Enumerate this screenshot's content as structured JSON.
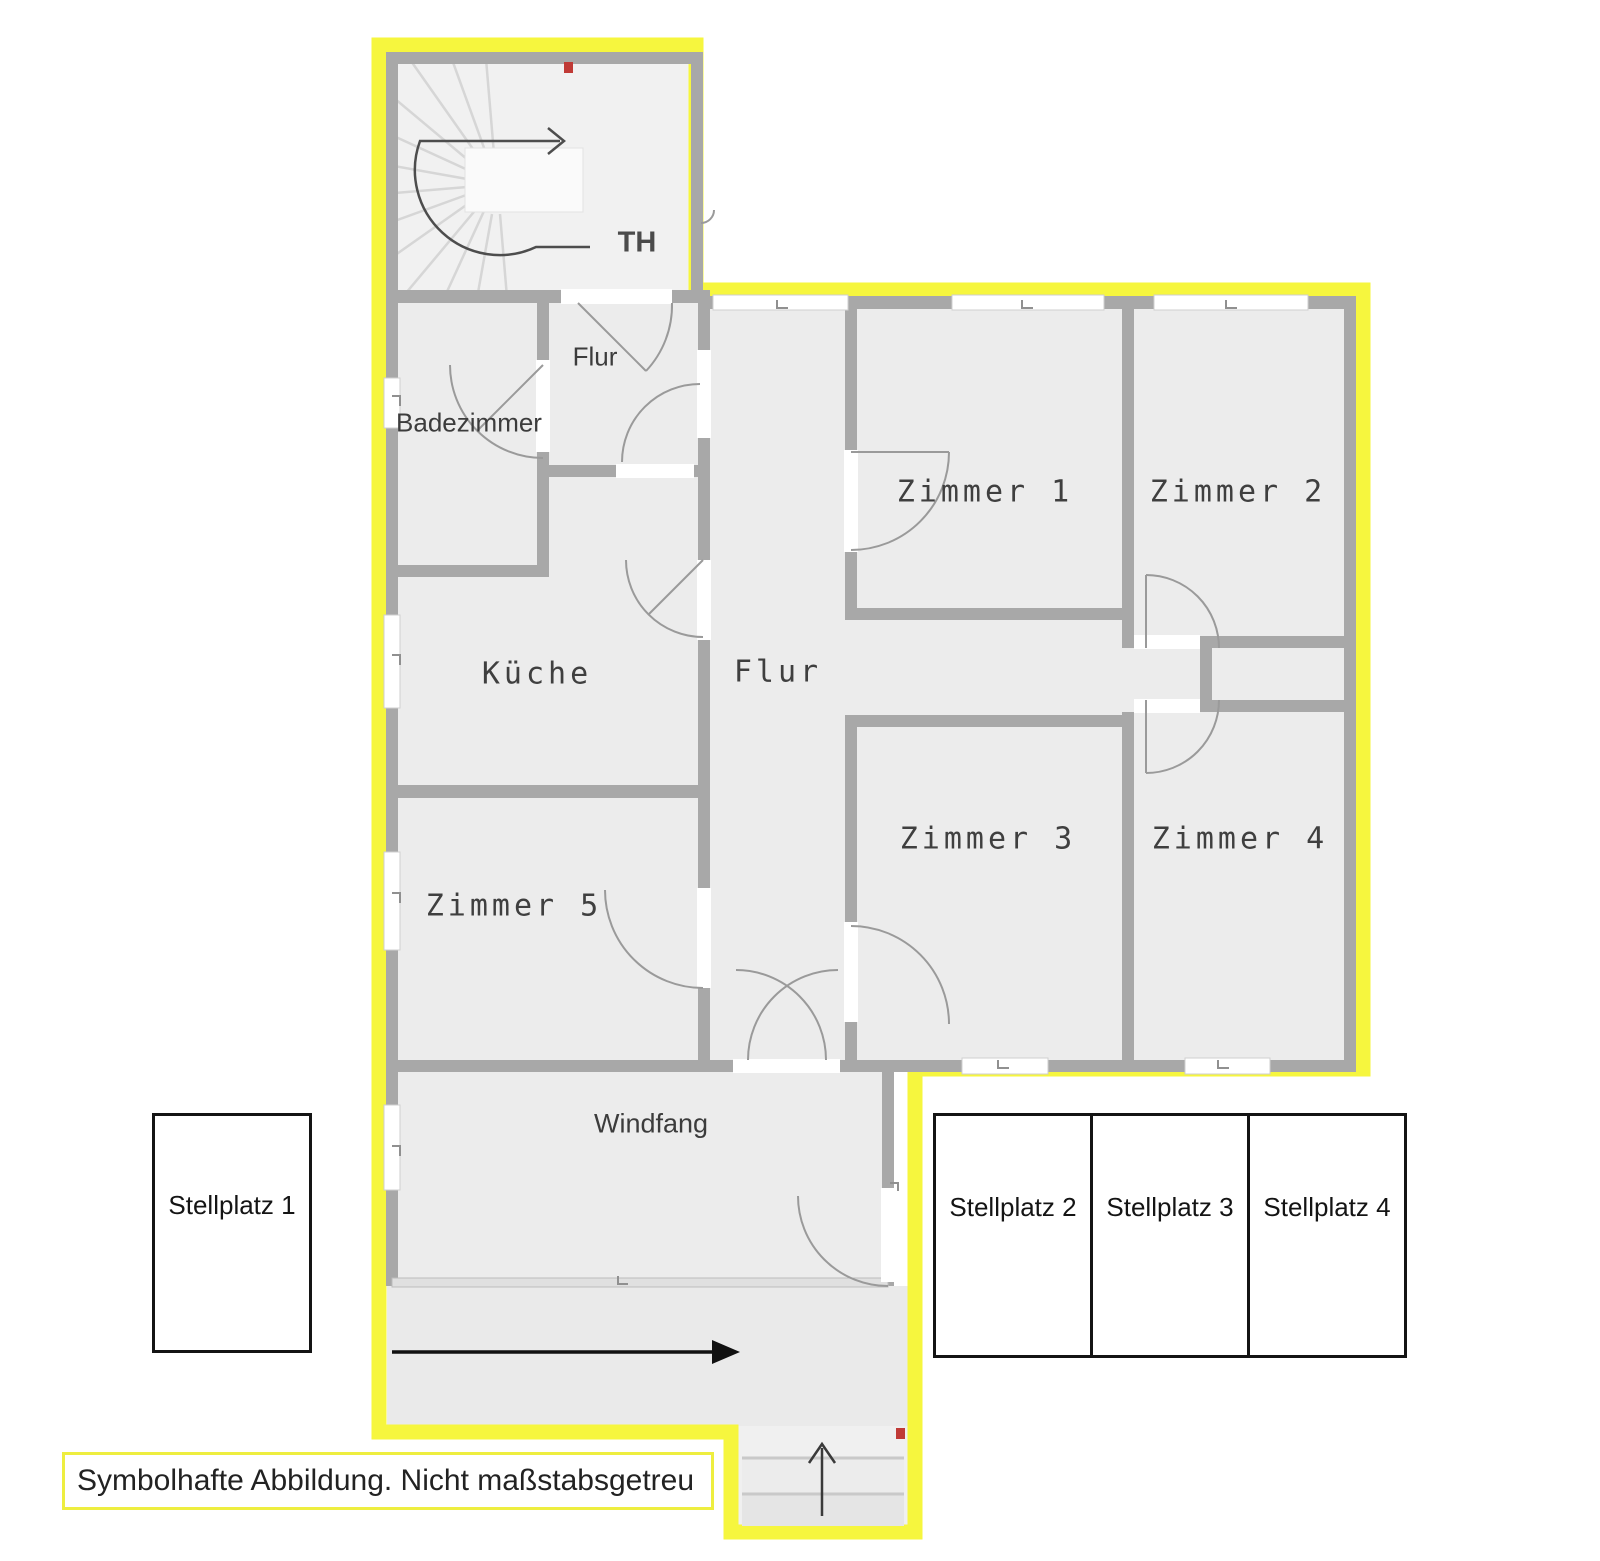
{
  "plan": {
    "rooms": {
      "th": "TH",
      "flur_upper": "Flur",
      "badezimmer": "Badezimmer",
      "kueche": "Küche",
      "flur_main": "Flur",
      "zimmer_1": "Zimmer 1",
      "zimmer_2": "Zimmer 2",
      "zimmer_3": "Zimmer 3",
      "zimmer_4": "Zimmer 4",
      "zimmer_5": "Zimmer 5",
      "windfang": "Windfang"
    },
    "parking": {
      "stellplatz_1": "Stellplatz 1",
      "stellplatz_2": "Stellplatz 2",
      "stellplatz_3": "Stellplatz 3",
      "stellplatz_4": "Stellplatz 4"
    },
    "disclaimer": "Symbolhafte Abbildung. Nicht maßstabsgetreu",
    "colors": {
      "unit_outline_yellow": "#f6f63e",
      "wall_gray": "#a8a8a8",
      "room_fill": "#ececec",
      "marker_red": "#c03a36",
      "parking_border": "#141414"
    },
    "icons": {
      "stair_direction": "right-arrow",
      "driveway_direction": "right-arrow",
      "entrance_direction": "up-arrow",
      "stairwell_marker": "red-dot",
      "entrance_marker": "red-dot"
    }
  }
}
